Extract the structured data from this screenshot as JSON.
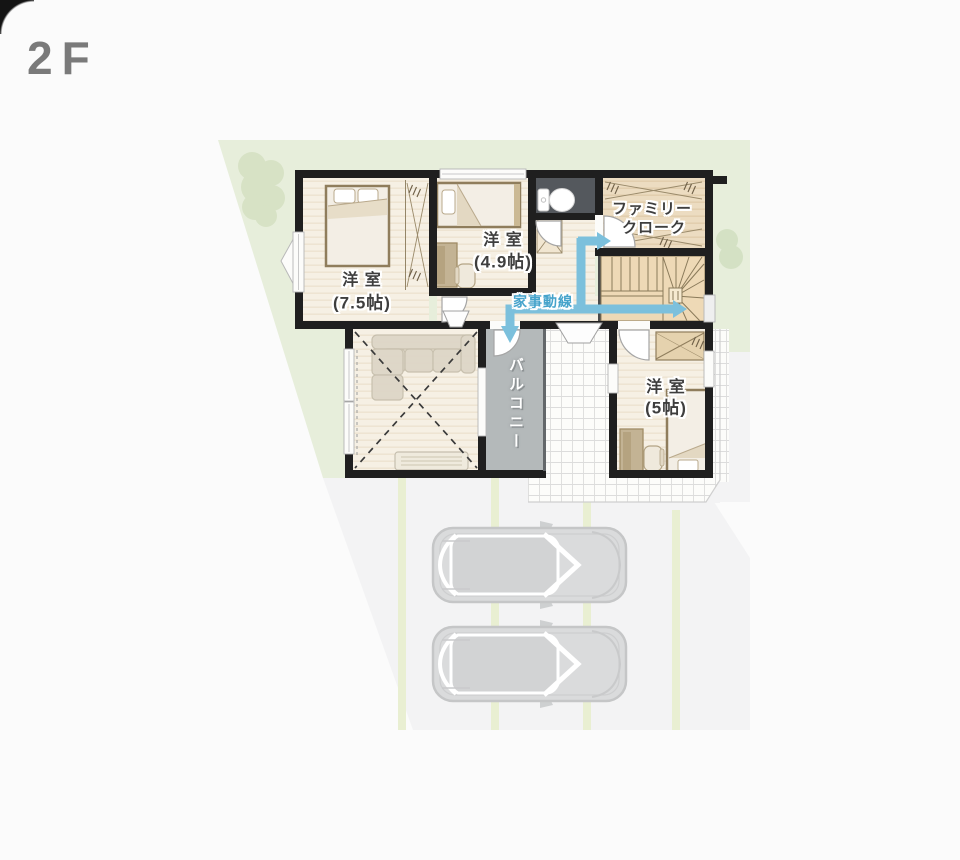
{
  "floor_label": "2F",
  "rooms": {
    "bedroom_75": {
      "name": "洋 室",
      "size": "(7.5帖)"
    },
    "bedroom_49": {
      "name": "洋 室",
      "size": "(4.9帖)"
    },
    "bedroom_5": {
      "name": "洋 室",
      "size": "(5帖)"
    },
    "family_closet": {
      "line1": "ファミリー",
      "line2": "クローク"
    },
    "balcony": {
      "name": "バルコニー"
    },
    "flow_line": {
      "label": "家事動線"
    }
  },
  "colors": {
    "flow_arrow_blue": "#7cc0dc",
    "flow_text_blue": "#45a3cb",
    "lot_green": "#e7eedb",
    "tree_green": "#d7e2c5",
    "road_gray": "#f3f3f4",
    "parking_stripe": "#e9efd2",
    "wall_black": "#1f1f1f",
    "floor_cream": "#f6f0e4",
    "closet_tan": "#ecdcc1",
    "stair_tan": "#eed9b6",
    "balcony_gray": "#b4b9ba",
    "toilet_dark": "#54585d",
    "title_gray": "#7a7a7a"
  }
}
